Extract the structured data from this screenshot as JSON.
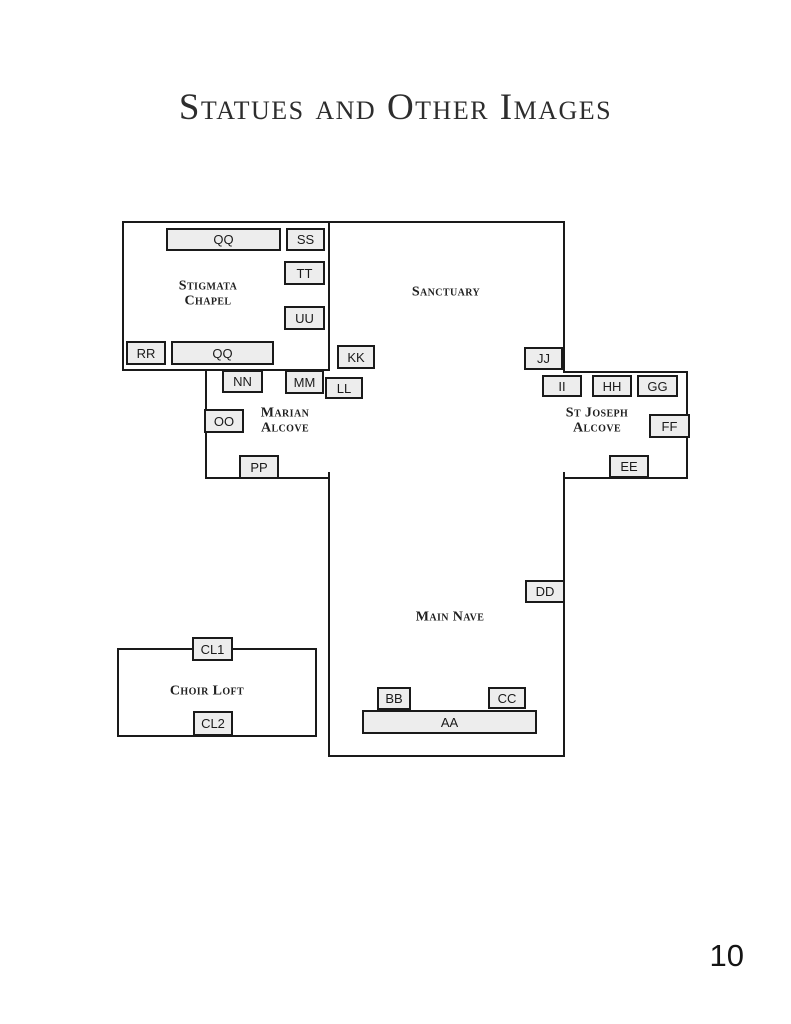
{
  "page": {
    "title": "Statues and Other Images",
    "page_number": "10"
  },
  "floorplan": {
    "colors": {
      "wall": "#1a1a1a",
      "marker_fill": "#ededed",
      "marker_border": "#1a1a1a"
    },
    "rooms": [
      {
        "id": "stigmata-chapel-outline",
        "x": 122,
        "y": 221,
        "w": 208,
        "h": 150
      },
      {
        "id": "choir-loft-outline",
        "x": 117,
        "y": 648,
        "w": 200,
        "h": 89
      }
    ],
    "walls": [
      {
        "id": "sanctuary-top",
        "x": 328,
        "y": 221,
        "w": 237,
        "h": 2
      },
      {
        "id": "sanctuary-right",
        "x": 563,
        "y": 221,
        "w": 2,
        "h": 152
      },
      {
        "id": "stjoseph-top",
        "x": 563,
        "y": 371,
        "w": 125,
        "h": 2
      },
      {
        "id": "stjoseph-right",
        "x": 686,
        "y": 371,
        "w": 2,
        "h": 108
      },
      {
        "id": "stjoseph-bottom",
        "x": 563,
        "y": 477,
        "w": 125,
        "h": 2
      },
      {
        "id": "marian-left",
        "x": 205,
        "y": 369,
        "w": 2,
        "h": 110
      },
      {
        "id": "marian-bottom",
        "x": 205,
        "y": 477,
        "w": 125,
        "h": 2
      },
      {
        "id": "nave-left",
        "x": 328,
        "y": 472,
        "w": 2,
        "h": 285
      },
      {
        "id": "nave-right",
        "x": 563,
        "y": 472,
        "w": 2,
        "h": 285
      },
      {
        "id": "nave-bottom",
        "x": 328,
        "y": 755,
        "w": 237,
        "h": 2
      }
    ],
    "areas": [
      {
        "id": "stigmata-chapel",
        "lines": [
          "Stigmata",
          "Chapel"
        ],
        "x": 208,
        "y": 294
      },
      {
        "id": "sanctuary",
        "lines": [
          "Sanctuary"
        ],
        "x": 446,
        "y": 292
      },
      {
        "id": "marian-alcove",
        "lines": [
          "Marian",
          "Alcove"
        ],
        "x": 285,
        "y": 421
      },
      {
        "id": "st-joseph-alcove",
        "lines": [
          "St Joseph",
          "Alcove"
        ],
        "x": 597,
        "y": 421
      },
      {
        "id": "main-nave",
        "lines": [
          "Main Nave"
        ],
        "x": 450,
        "y": 617
      },
      {
        "id": "choir-loft",
        "lines": [
          "Choir Loft"
        ],
        "x": 207,
        "y": 691
      }
    ],
    "markers": [
      {
        "id": "QQ-top",
        "label": "QQ",
        "x": 166,
        "y": 228,
        "w": 115,
        "h": 23
      },
      {
        "id": "SS",
        "label": "SS",
        "x": 286,
        "y": 228,
        "w": 39,
        "h": 23
      },
      {
        "id": "TT",
        "label": "TT",
        "x": 284,
        "y": 261,
        "w": 41,
        "h": 24
      },
      {
        "id": "UU",
        "label": "UU",
        "x": 284,
        "y": 306,
        "w": 41,
        "h": 24
      },
      {
        "id": "RR",
        "label": "RR",
        "x": 126,
        "y": 341,
        "w": 40,
        "h": 24
      },
      {
        "id": "QQ-bottom",
        "label": "QQ",
        "x": 171,
        "y": 341,
        "w": 103,
        "h": 24
      },
      {
        "id": "KK",
        "label": "KK",
        "x": 337,
        "y": 345,
        "w": 38,
        "h": 24
      },
      {
        "id": "NN",
        "label": "NN",
        "x": 222,
        "y": 370,
        "w": 41,
        "h": 23
      },
      {
        "id": "MM",
        "label": "MM",
        "x": 285,
        "y": 370,
        "w": 39,
        "h": 24
      },
      {
        "id": "LL",
        "label": "LL",
        "x": 325,
        "y": 377,
        "w": 38,
        "h": 22
      },
      {
        "id": "OO",
        "label": "OO",
        "x": 204,
        "y": 409,
        "w": 40,
        "h": 24
      },
      {
        "id": "PP",
        "label": "PP",
        "x": 239,
        "y": 455,
        "w": 40,
        "h": 24
      },
      {
        "id": "JJ",
        "label": "JJ",
        "x": 524,
        "y": 347,
        "w": 39,
        "h": 23
      },
      {
        "id": "II",
        "label": "II",
        "x": 542,
        "y": 375,
        "w": 40,
        "h": 22
      },
      {
        "id": "HH",
        "label": "HH",
        "x": 592,
        "y": 375,
        "w": 40,
        "h": 22
      },
      {
        "id": "GG",
        "label": "GG",
        "x": 637,
        "y": 375,
        "w": 41,
        "h": 22
      },
      {
        "id": "FF",
        "label": "FF",
        "x": 649,
        "y": 414,
        "w": 41,
        "h": 24
      },
      {
        "id": "EE",
        "label": "EE",
        "x": 609,
        "y": 455,
        "w": 40,
        "h": 23
      },
      {
        "id": "DD",
        "label": "DD",
        "x": 525,
        "y": 580,
        "w": 40,
        "h": 23
      },
      {
        "id": "BB",
        "label": "BB",
        "x": 377,
        "y": 687,
        "w": 34,
        "h": 23
      },
      {
        "id": "CC",
        "label": "CC",
        "x": 488,
        "y": 687,
        "w": 38,
        "h": 22
      },
      {
        "id": "AA",
        "label": "AA",
        "x": 362,
        "y": 710,
        "w": 175,
        "h": 24
      },
      {
        "id": "CL1",
        "label": "CL1",
        "x": 192,
        "y": 637,
        "w": 41,
        "h": 24
      },
      {
        "id": "CL2",
        "label": "CL2",
        "x": 193,
        "y": 711,
        "w": 40,
        "h": 25
      }
    ]
  }
}
